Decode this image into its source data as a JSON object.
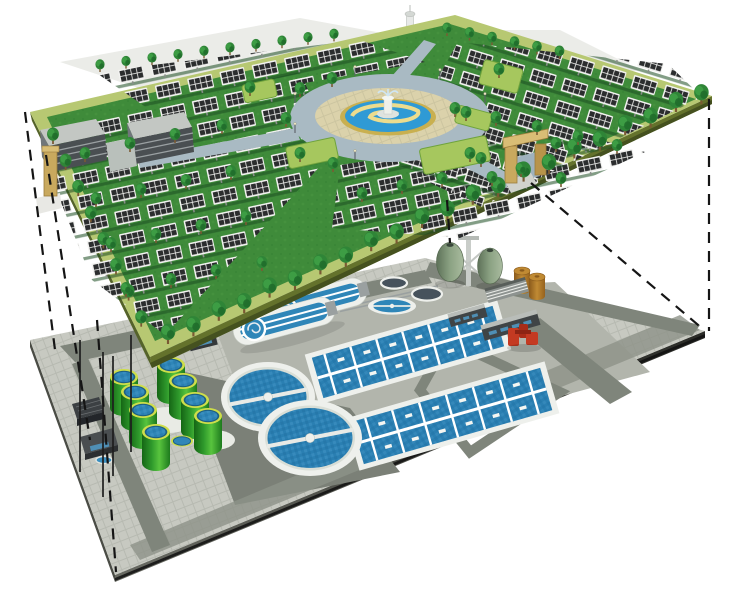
{
  "description": "Cutaway axonometric illustration: a landscaped solar park with trees, photovoltaic arrays, two office buildings, entrance gates and a circular fountain plaza sits on a green deck above an underground wastewater treatment plant; dashed projection lines link the corners of the upper park deck to the buried plant slab below.",
  "upper_layer": {
    "name": "rooftop-solar-park",
    "components": [
      {
        "name": "solar-panel-arrays",
        "note": "rows of dark PV panels with white frames"
      },
      {
        "name": "trees",
        "note": "dense perimeter rows and scattered field trees"
      },
      {
        "name": "fountain-plaza",
        "note": "circular ring road, cobble ring, gold basin, blue pool with swirl and central fountain"
      },
      {
        "name": "office-buildings",
        "count": 2
      },
      {
        "name": "entrance-gates",
        "count": 2,
        "note": "tan portal frames on west and south edges"
      },
      {
        "name": "observation-tower",
        "count": 1
      },
      {
        "name": "hedge-planters",
        "count": 5
      },
      {
        "name": "lamp-posts",
        "count": 8
      }
    ]
  },
  "lower_layer": {
    "name": "underground-wastewater-plant",
    "components": [
      {
        "name": "oxidation-ditches",
        "count": 2
      },
      {
        "name": "aeration-basins",
        "count": 2
      },
      {
        "name": "secondary-clarifiers",
        "count": 2
      },
      {
        "name": "small-clarifier",
        "count": 1
      },
      {
        "name": "covered-tanks",
        "count": 2
      },
      {
        "name": "green-digester-tanks",
        "count": 8
      },
      {
        "name": "egg-shaped-digesters",
        "count": 2
      },
      {
        "name": "brown-storage-tanks",
        "count": 2
      },
      {
        "name": "red-pump-unit",
        "count": 1
      },
      {
        "name": "plant-buildings",
        "count": 6
      },
      {
        "name": "lightning-masts",
        "count": 4
      },
      {
        "name": "navy-holding-tank",
        "count": 1
      }
    ]
  },
  "projection": {
    "dashed_lines": 6,
    "style": "black dashed construction lines joining upper deck corners to buried slab corners"
  },
  "palette": {
    "bg": "#ffffff",
    "grass": "#3f8b3a",
    "grass-dark": "#2e7a30",
    "border-band": "#b7c872",
    "platform-side": "#64722c",
    "platform-side-dark": "#45511f",
    "panel-cell": "#2b2d2e",
    "panel-frame": "#f2f2f0",
    "tree-green": "#2f8537",
    "tree-dark": "#1f6b2a",
    "tree-light": "#3fa046",
    "ring-road": "#a9bac3",
    "cobble": "#dbd2ab",
    "fountain-ring": "#c9b050",
    "pool-blue": "#2f9ad5",
    "pool-swirl": "#ecdc8e",
    "building-roof": "#c3c7c3",
    "building-face": "#4a4f52",
    "gate-tan": "#c9a95e",
    "gate-tan-dark": "#9c7c3c",
    "gate-tan-light": "#d9bd75",
    "pavement": "#c7c9c1",
    "road-gray": "#7f857b",
    "apron-dark": "#7b8077",
    "work-zone": "#b2b5ac",
    "slab-side": "#3c3e39",
    "wall-white": "#eef0ec",
    "wall-shade": "#d9ded6",
    "water-blue": "#2a7fb2",
    "water-light": "#54a3cf",
    "tank-rim": "#cede4a",
    "egg-green": "#8ba283",
    "barrel-brown": "#a86a20",
    "barrel-light": "#c08a33",
    "pump-red": "#c43a22",
    "navy-tank": "#274e73",
    "mast-black": "#1e1e1e",
    "dash-black": "#151515",
    "backdrop": "#ebece8"
  }
}
